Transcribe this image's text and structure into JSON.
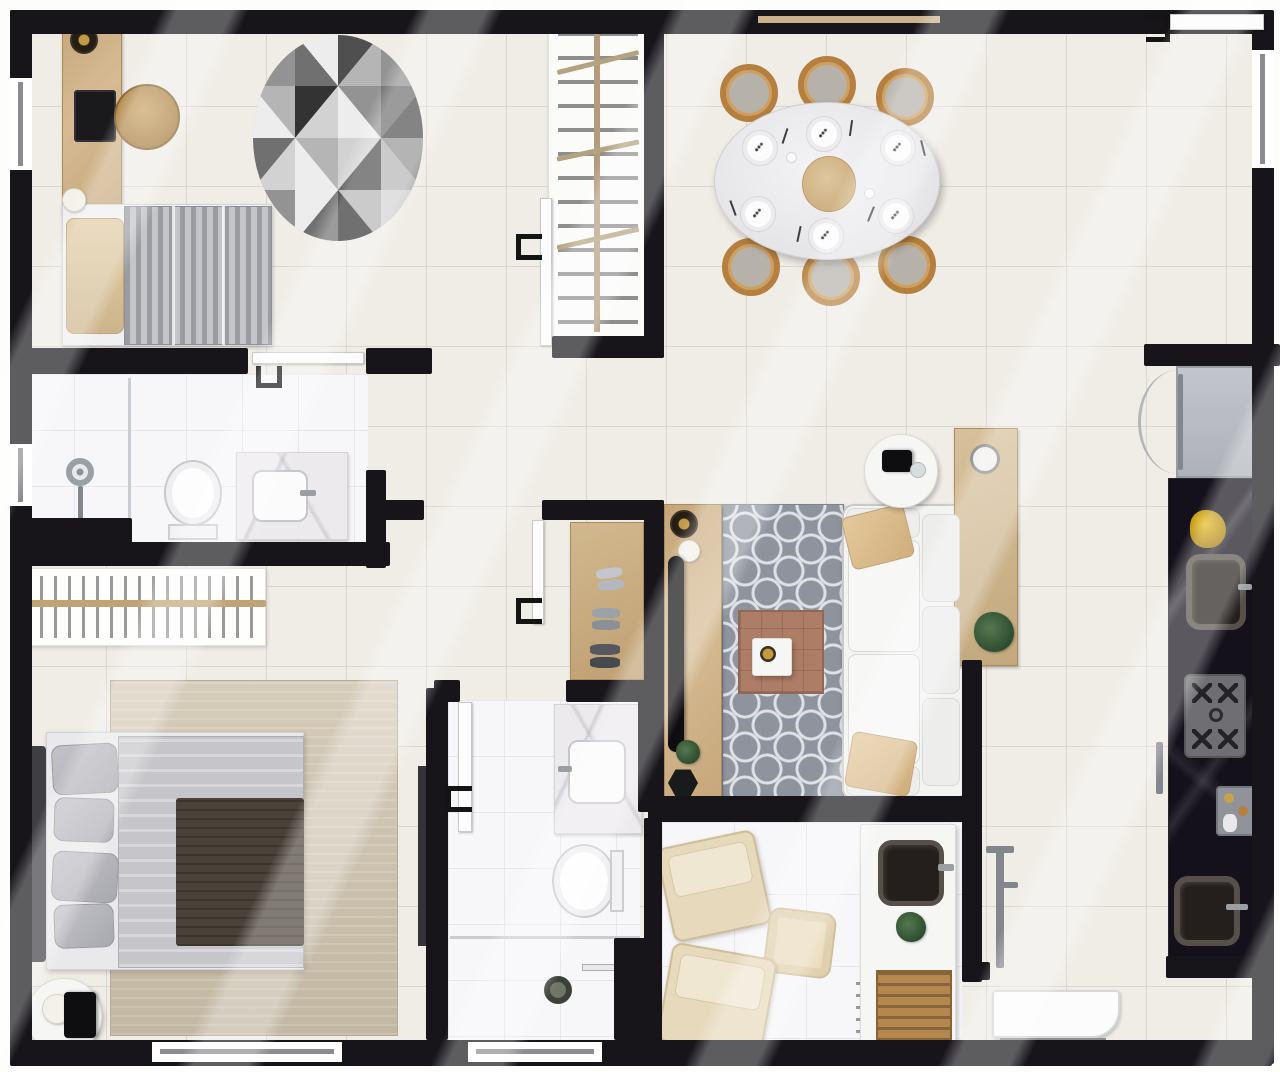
{
  "meta": {
    "type": "apartment-floor-plan",
    "view": "top-down-render",
    "canvas": "1280x1072",
    "visible_text": "none"
  },
  "palette": {
    "wall": "#17151a",
    "floor": "#f0ede7",
    "floor-line": "#dbd7d0",
    "bath-floor": "#f7f7f9",
    "bath-line": "#e6e6ec",
    "wood": "#c6a67a",
    "counter-black": "#14111a",
    "rug-gray": "#8e939d",
    "rug-beige": "#cbc0ad",
    "sofa-white": "#f3f3f2",
    "pillow-beige": "#dcbf94",
    "duvet-silver": "#c6c6ca",
    "throw-brown": "#4a4238",
    "accent-green": "#3c6140",
    "terracotta": "#ad7d66",
    "chair-wood": "#b5803f"
  },
  "rooms": [
    {
      "id": "bedroom-1",
      "label": "Bedroom 1",
      "furniture": [
        "desk",
        "laptop",
        "rattan-stool",
        "decor-bowl",
        "table-lamp",
        "single-bed-gray-striped",
        "beige-pillow",
        "round-mosaic-rug",
        "open-wardrobe-with-hangers"
      ]
    },
    {
      "id": "dining-room",
      "label": "Dining Room",
      "furniture": [
        "oval-dining-table",
        "dining-chairs-x6",
        "place-settings-x6",
        "center-platter",
        "mini-dishes-x2"
      ]
    },
    {
      "id": "kitchen",
      "label": "Kitchen (galley)",
      "furniture": [
        "refrigerator",
        "black-marble-counter",
        "fruit-bowl",
        "sink-upper",
        "gas-stove-4-burner",
        "coffee-machine",
        "sink-lower"
      ]
    },
    {
      "id": "bathroom-1",
      "label": "Bathroom 1",
      "furniture": [
        "shower-head",
        "glass-partition",
        "toilet",
        "marble-vanity",
        "basin"
      ]
    },
    {
      "id": "hall-closet",
      "label": "Entry Hall Closet",
      "furniture": [
        "shoe-bench",
        "shoes-x3-pairs"
      ]
    },
    {
      "id": "living-room",
      "label": "Living Room",
      "furniture": [
        "tv-console",
        "tv",
        "decor-bowl-black",
        "decor-bowl-white",
        "plant",
        "hex-side-stool",
        "patterned-rug",
        "coffee-table-terracotta",
        "tray",
        "sofa-white-3-seat",
        "throw-pillows-x2",
        "round-side-table",
        "camera-decor",
        "glass-cup",
        "console-table",
        "metal-dish",
        "plant-2"
      ]
    },
    {
      "id": "master-bedroom",
      "label": "Master Bedroom",
      "furniture": [
        "double-bed",
        "dark-headboard",
        "silver-pillows-x4",
        "silver-duvet",
        "brown-throw",
        "beige-area-rug",
        "round-side-table",
        "lamp",
        "wall-rack-slatted",
        "wardrobe-door"
      ]
    },
    {
      "id": "bathroom-2",
      "label": "Bathroom 2 (en-suite)",
      "furniture": [
        "marble-vanity",
        "basin",
        "toilet",
        "shower-area",
        "floor-drain",
        "grab-bar"
      ]
    },
    {
      "id": "balcony-lounge",
      "label": "Balcony Lounge",
      "furniture": [
        "lounge-chair-x2",
        "pouf",
        "counter-with-sink",
        "plant",
        "wood-crate"
      ]
    },
    {
      "id": "service-area",
      "label": "Service Area",
      "furniture": [
        "tall-faucet",
        "laundry-tub"
      ]
    }
  ],
  "counts": {
    "bedrooms": 2,
    "bathrooms": 2,
    "dining_chairs": 6,
    "dining_places": 6,
    "stove_burners": 4,
    "windows": 5,
    "doors": 5
  }
}
